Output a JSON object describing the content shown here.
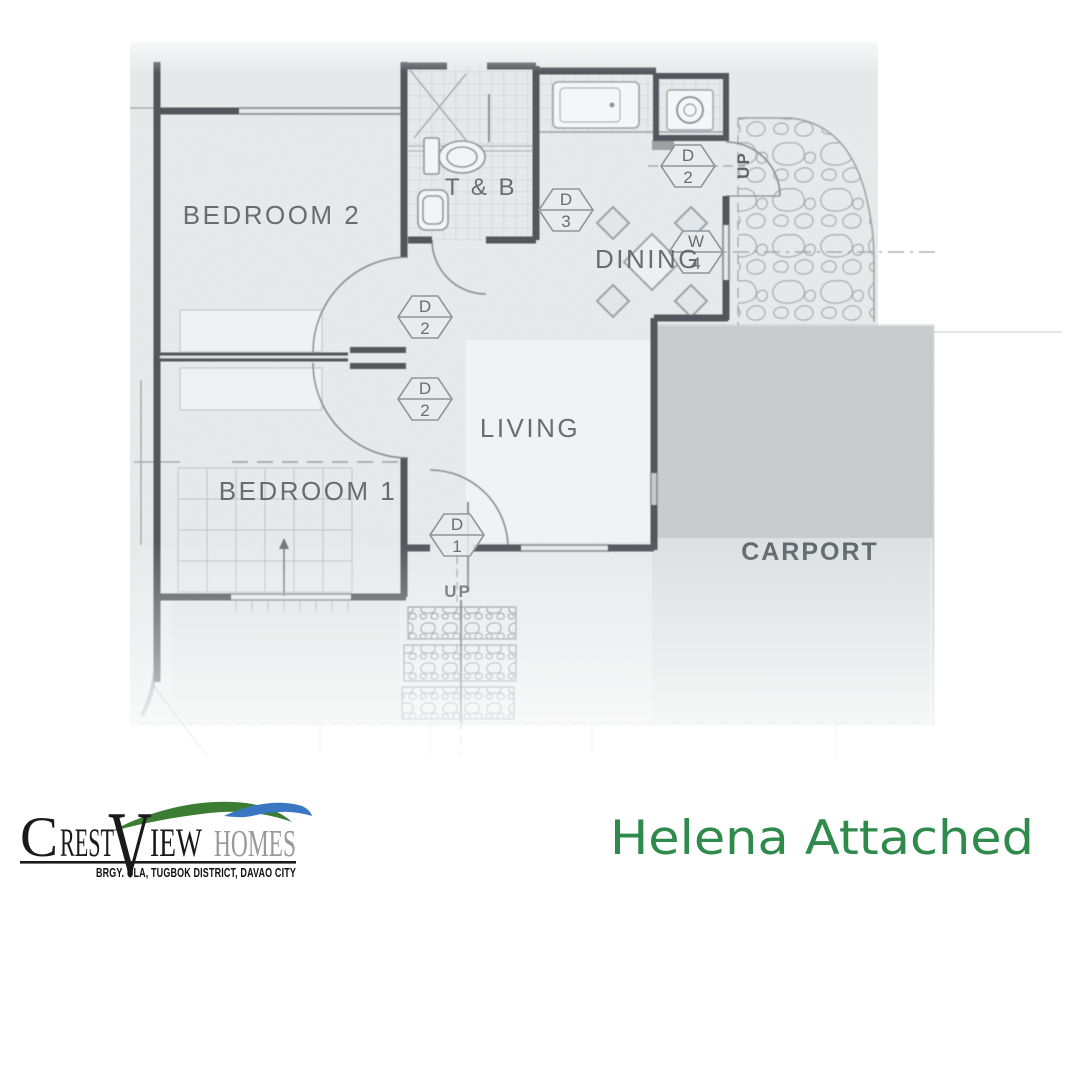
{
  "branding": {
    "logo": {
      "part_c": "C",
      "part_rest": "REST",
      "part_v": "V",
      "part_iew": "IEW",
      "part_homes": "HOMES",
      "tagline": "BRGY. ULA, TUGBOK DISTRICT, DAVAO CITY"
    },
    "colors": {
      "swoosh_green": "#3b7d33",
      "swoosh_blue": "#3a77c2",
      "homes_gray": "#98999b",
      "wordmark_black": "#1a1a1a"
    }
  },
  "hero_title": {
    "text": "Helena Attached",
    "color": "#2e8b4b"
  },
  "floor_plan": {
    "rooms": {
      "bedroom2": "BEDROOM 2",
      "toilet_bath": "T & B",
      "dining": "DINING",
      "living": "LIVING",
      "bedroom1": "BEDROOM 1",
      "carport": "CARPORT"
    },
    "labels": {
      "up_entry": "UP",
      "up_path": "UP"
    },
    "door_tags": {
      "d3_dining": {
        "letter": "D",
        "number": "3"
      },
      "d2_kitchen": {
        "letter": "D",
        "number": "2"
      },
      "w4_dining": {
        "letter": "W",
        "number": "4"
      },
      "d2_bedroom2": {
        "letter": "D",
        "number": "2"
      },
      "d2_bedroom1": {
        "letter": "D",
        "number": "2"
      },
      "d1_entry": {
        "letter": "D",
        "number": "1"
      }
    },
    "palette": {
      "paper": "#e9ebec",
      "wall": "#53565b",
      "carport_shade": "#c9cccd",
      "carport_shade_light": "#dde0e1"
    }
  }
}
